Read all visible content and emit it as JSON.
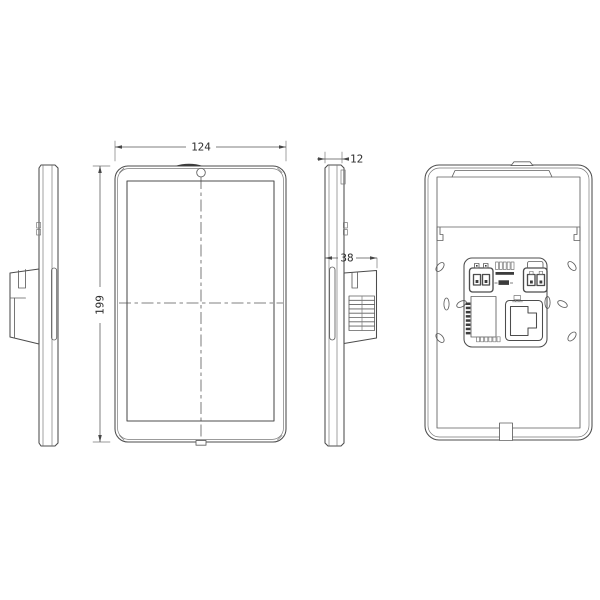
{
  "drawing": {
    "background": "#ffffff",
    "line_color": "#4c4c4c",
    "dimensions": {
      "front_width": "124",
      "front_height": "199",
      "panel_thickness": "12",
      "mount_depth": "38"
    }
  }
}
